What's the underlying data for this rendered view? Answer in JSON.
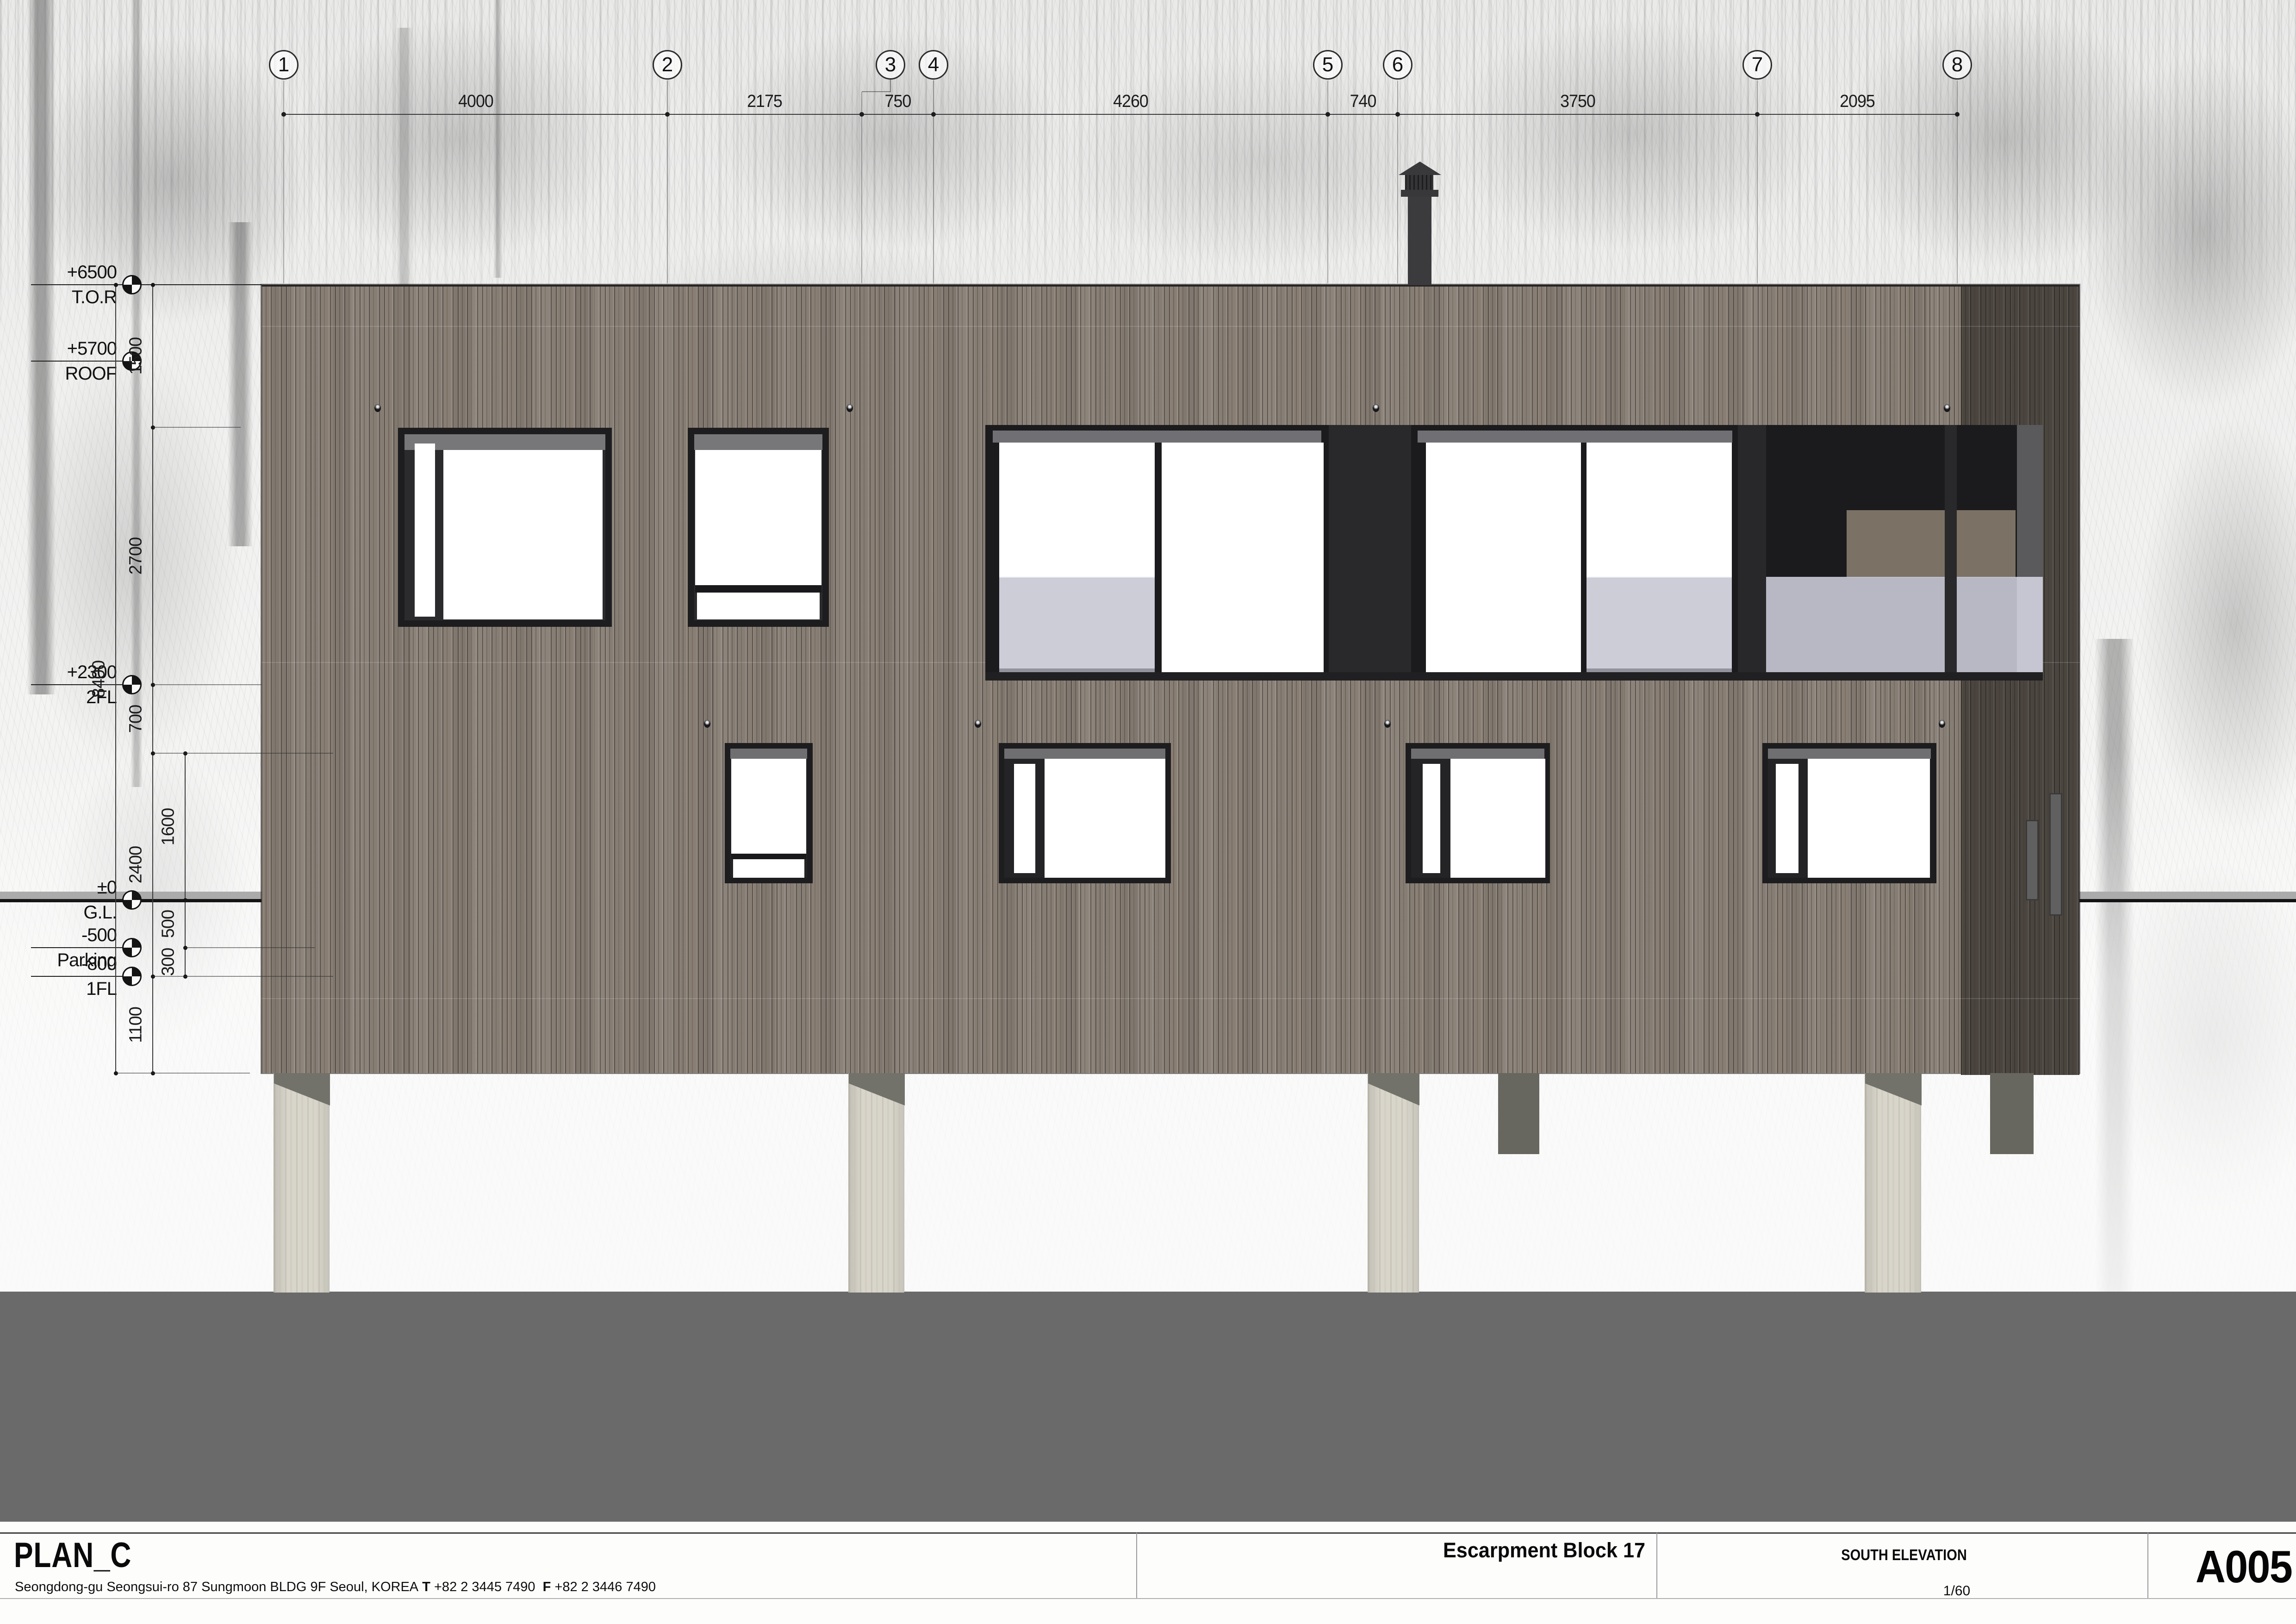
{
  "drawing": {
    "grid_labels": [
      "1",
      "2",
      "3",
      "4",
      "5",
      "6",
      "7",
      "8"
    ],
    "top_dimensions": [
      "4000",
      "2175",
      "750",
      "4260",
      "740",
      "3750",
      "2095"
    ],
    "levels": [
      {
        "value": "+6500",
        "name": "T.O.R"
      },
      {
        "value": "+5700",
        "name": "ROOF"
      },
      {
        "value": "+2300",
        "name": "2FL"
      },
      {
        "value": "±0",
        "name": "G.L."
      },
      {
        "value": "-500",
        "name": "Parking"
      },
      {
        "value": "-800",
        "name": "1FL"
      }
    ],
    "vertical_dimensions": {
      "overall": "8400",
      "chain": [
        "1500",
        "2700",
        "700",
        "2400",
        "1100"
      ],
      "sub_chain": [
        "1600",
        "500",
        "300"
      ]
    }
  },
  "title_block": {
    "firm": "PLAN_C",
    "address": "Seongdong-gu Seongsui-ro 87 Sungmoon BLDG 9F Seoul, KOREA",
    "tel_label": "T",
    "tel": "+82 2 3445 7490",
    "fax_label": "F",
    "fax": "+82 2 3446 7490",
    "project": "Escarpment Block 17",
    "view_name": "SOUTH ELEVATION",
    "scale": "1/60",
    "sheet_number": "A005"
  },
  "colors": {
    "wood": "#8b8279",
    "wood_dark": "#59524b",
    "window_frame": "#1d1d1f",
    "glass": "#ffffff",
    "guard_glass": "#cbcbd7",
    "concrete": "#d8d5cb",
    "ground": "#6a6a6a",
    "accent_dark": "#2a2a2c"
  }
}
